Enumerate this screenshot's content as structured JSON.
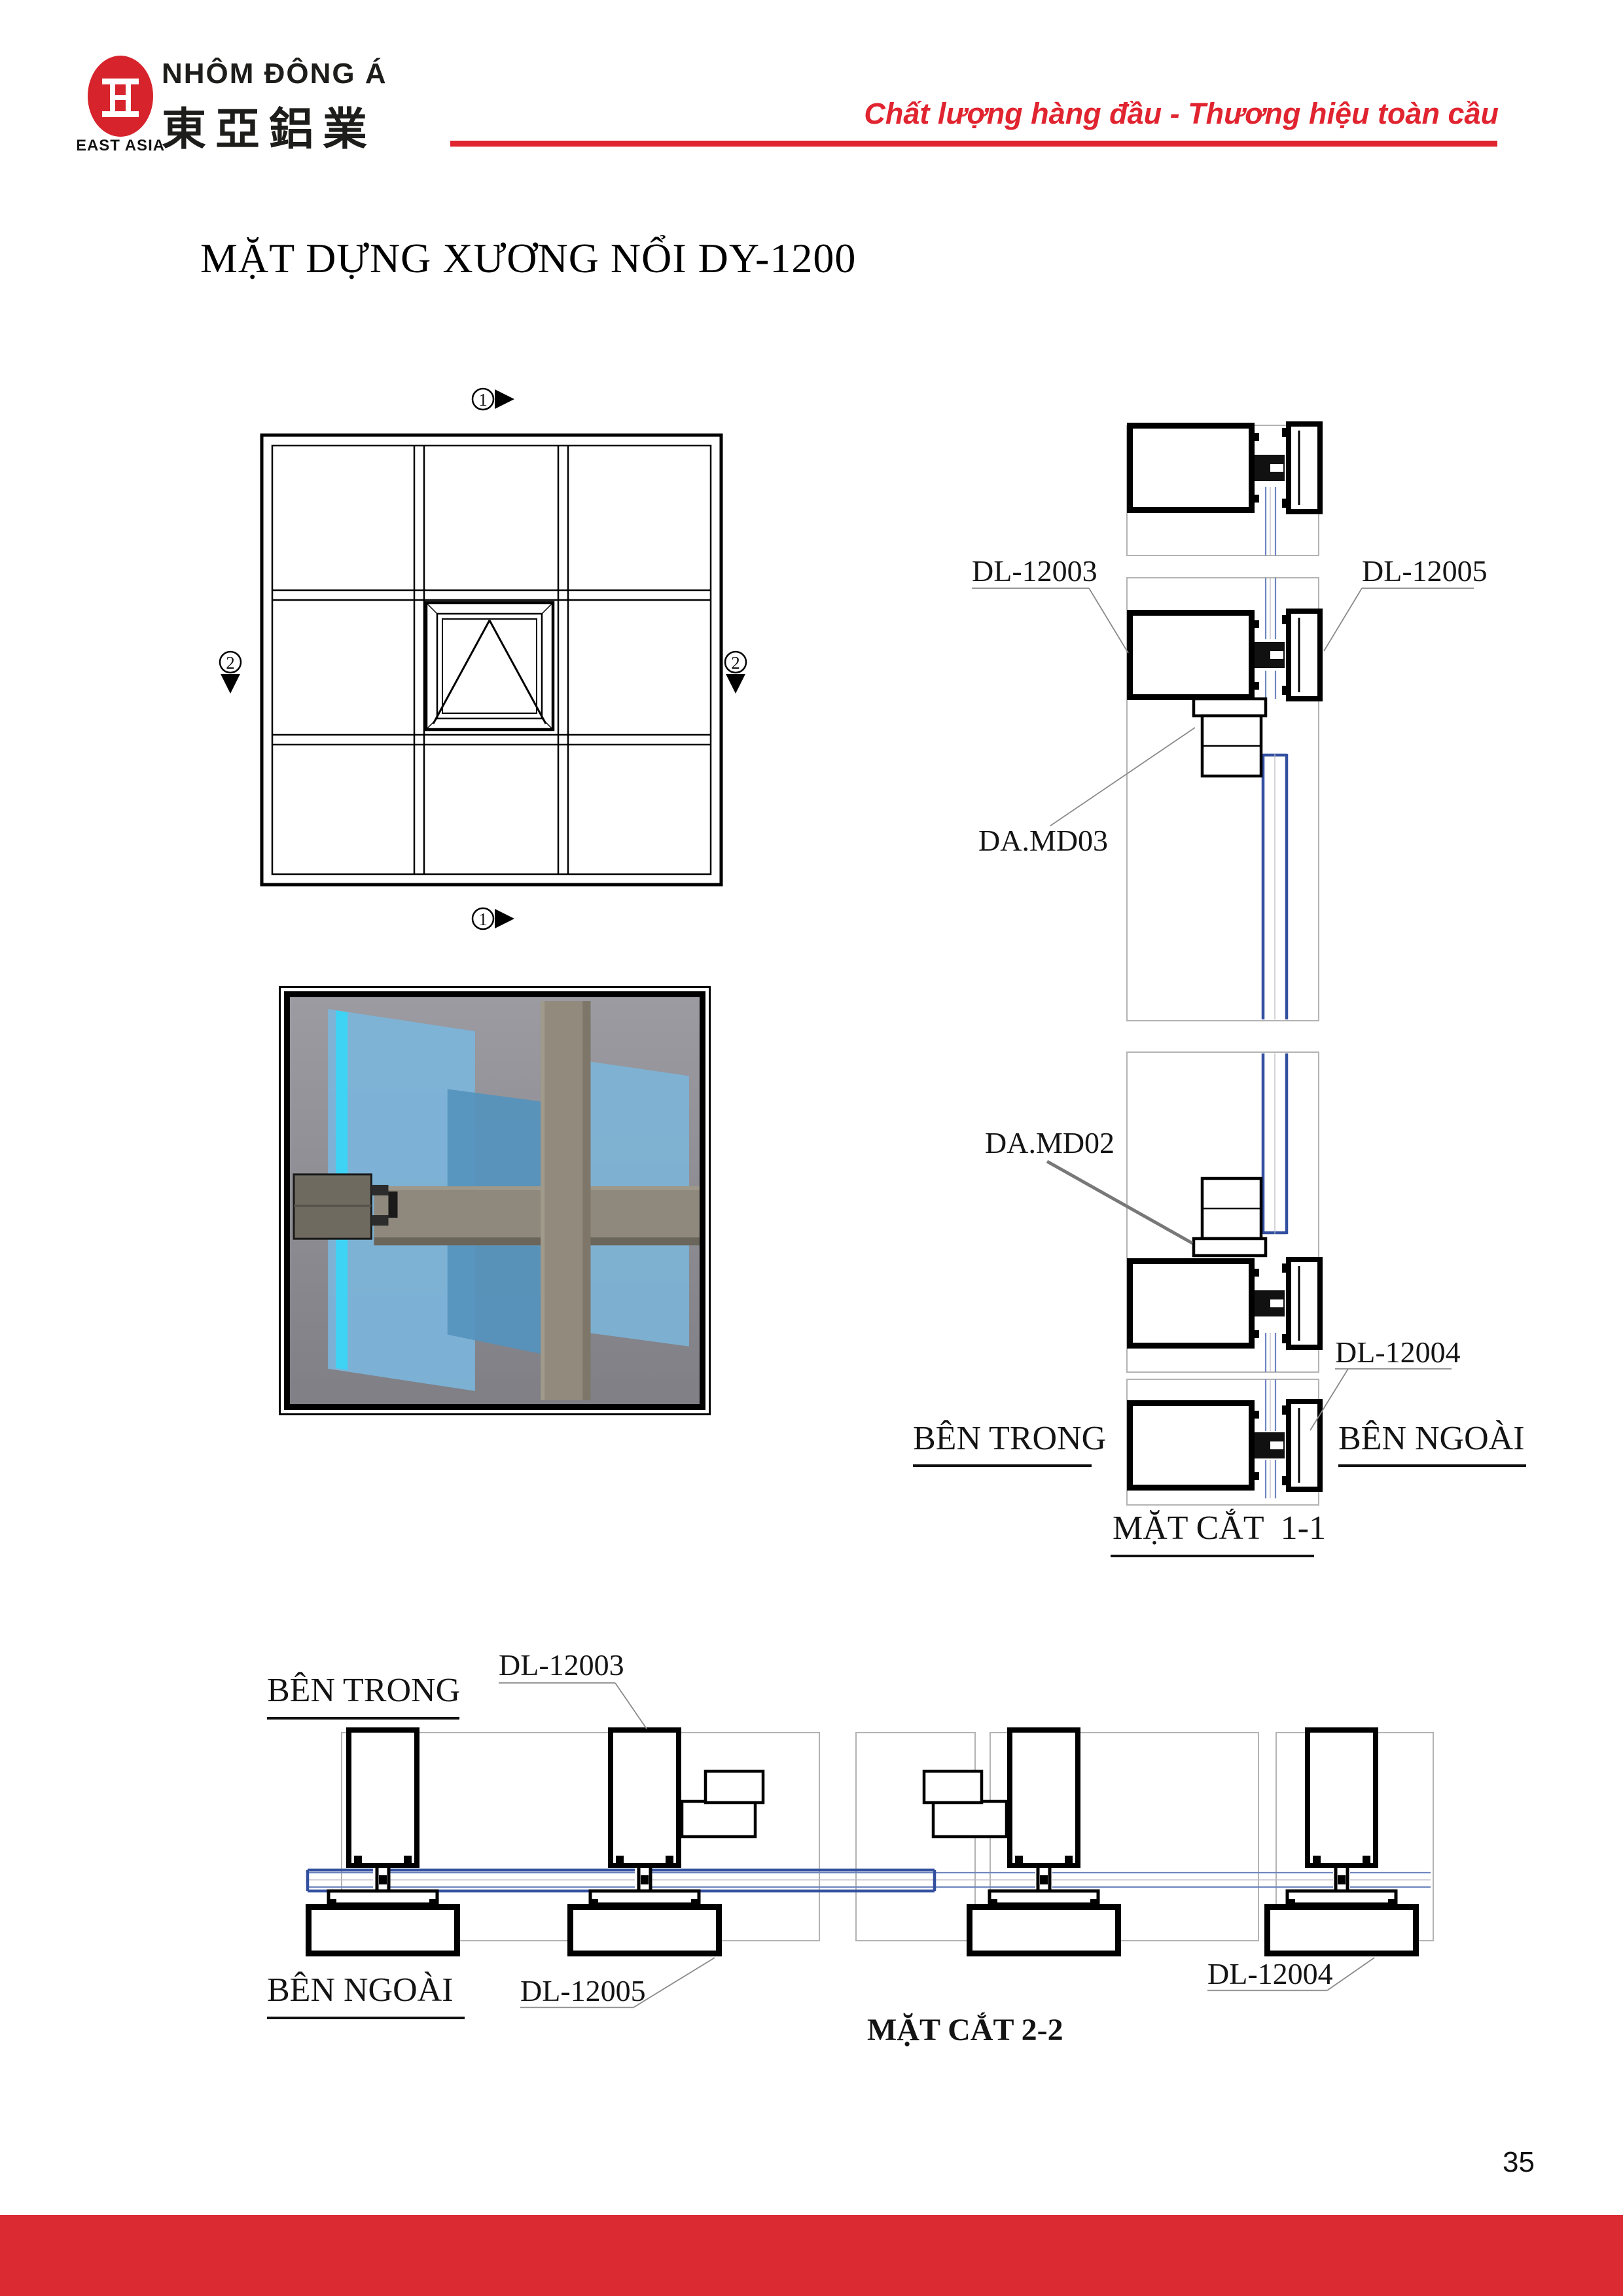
{
  "header": {
    "logo": {
      "glyph": "亞",
      "subtext": "EAST ASIA"
    },
    "company_vi": "NHÔM ĐÔNG Á",
    "company_cn": "東亞鋁業",
    "tagline": "Chất lượng hàng đầu - Thương hiệu toàn cầu"
  },
  "title": "MẶT DỰNG XƯƠNG NỔI DY-1200",
  "elevation": {
    "markers": {
      "top": "1",
      "bottom": "1",
      "left": "2",
      "right": "2"
    }
  },
  "section1": {
    "labels": {
      "dl12003": "DL-12003",
      "dl12005": "DL-12005",
      "damd03": "DA.MD03",
      "damd02": "DA.MD02",
      "dl12004": "DL-12004",
      "ben_trong": "BÊN TRONG",
      "ben_ngoai": "BÊN NGOÀI"
    },
    "title": "MẶT CẮT  1-1"
  },
  "section2": {
    "labels": {
      "ben_trong": "BÊN TRONG",
      "ben_ngoai": "BÊN NGOÀI",
      "dl12003": "DL-12003",
      "dl12005": "DL-12005",
      "dl12004": "DL-12004"
    },
    "title": "MẶT CẮT 2-2"
  },
  "footer": {
    "page_number": "35"
  },
  "colors": {
    "brand_red": "#E02430",
    "footer_red": "#DC2A33",
    "logo_red": "#D7232C",
    "glass_blue": "#6F86C0",
    "vent_glass_blue": "#3350A0",
    "panel_gray": "#B3B3B3"
  }
}
